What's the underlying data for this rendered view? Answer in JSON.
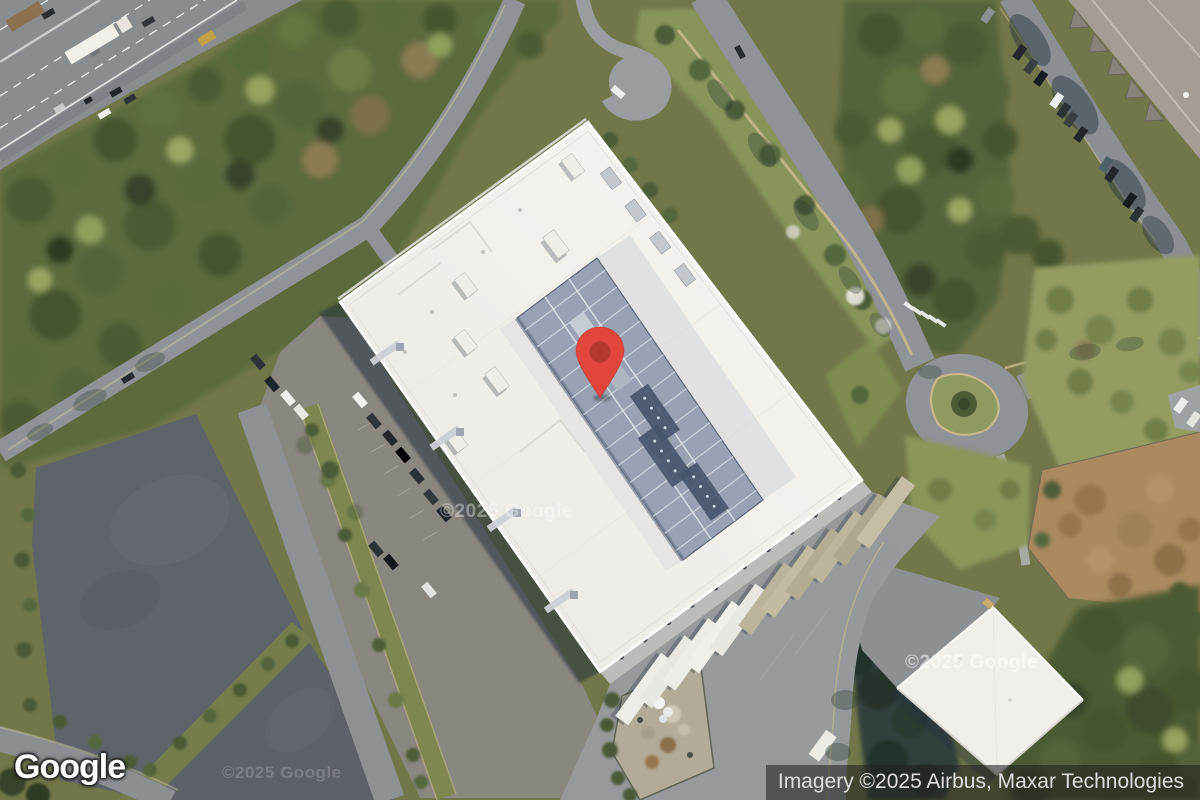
{
  "branding": {
    "logo_text": "Google"
  },
  "attribution": {
    "text": "Imagery ©2025 Airbus, Maxar Technologies"
  },
  "watermarks": {
    "center": "©2025 Google",
    "on_building": "©2025 Google",
    "bottom_left": "©2025 Google"
  },
  "marker": {
    "body_color": "#E1453B",
    "dot_color": "#B2382C"
  },
  "colors": {
    "attribution_bg": "rgba(32,32,32,0.58)",
    "attribution_text": "#DEDEDE",
    "logo_text": "#FFFFFF",
    "building_roof": "#F4F2ED",
    "roof_equipment": "#8E99A9",
    "asphalt_road": "#8F9296",
    "empty_lot": "#5F646B",
    "forest": "#55633A",
    "dirt": "#AB8A5F"
  }
}
